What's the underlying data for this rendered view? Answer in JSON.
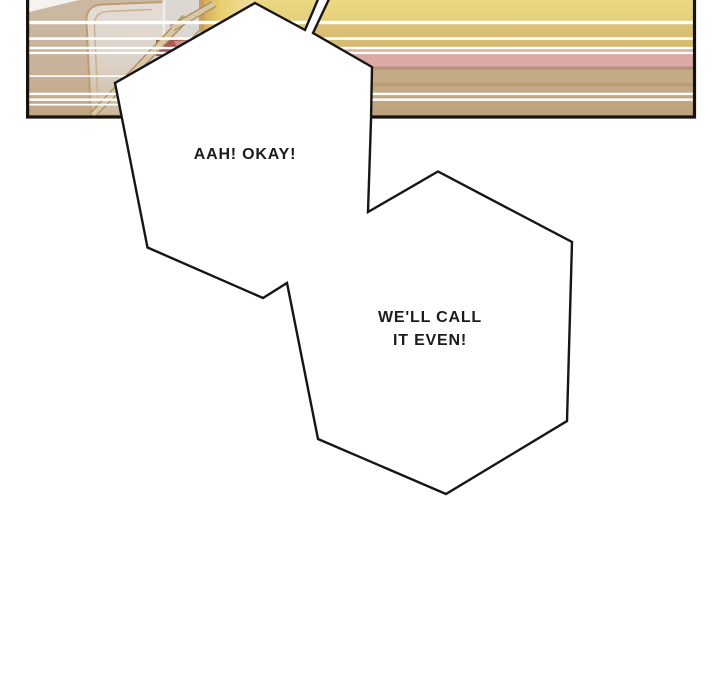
{
  "scene": {
    "kind": "webtoon-comic-panel",
    "background": "#ffffff"
  },
  "bubbles": {
    "first": {
      "text": "AAH! OKAY!"
    },
    "second": {
      "line1": "WE'LL CALL",
      "line2": "IT EVEN!"
    }
  },
  "palette": {
    "page_background": "#ffffff",
    "panel_border": "#17120e",
    "bubble_fill": "#ffffff",
    "bubble_outline": "#161616",
    "band_yellow": "#e9d47e",
    "band_gold": "#d8be72",
    "band_pink": "#dcaaa4",
    "band_mauve_line": "#ba8f81",
    "band_tan": "#c3aa84",
    "furniture_light_panel": "#e2dcd6",
    "furniture_tan_base": "#cbb8a1",
    "slat_tan": "#d9c6a3",
    "slat_edge": "#a98d66",
    "accent_red_patch": "#a35a52",
    "accent_yellow_lamp": "#e9cf6f",
    "speed_line_white": "#ffffff",
    "text_color": "#1c1c1c"
  }
}
